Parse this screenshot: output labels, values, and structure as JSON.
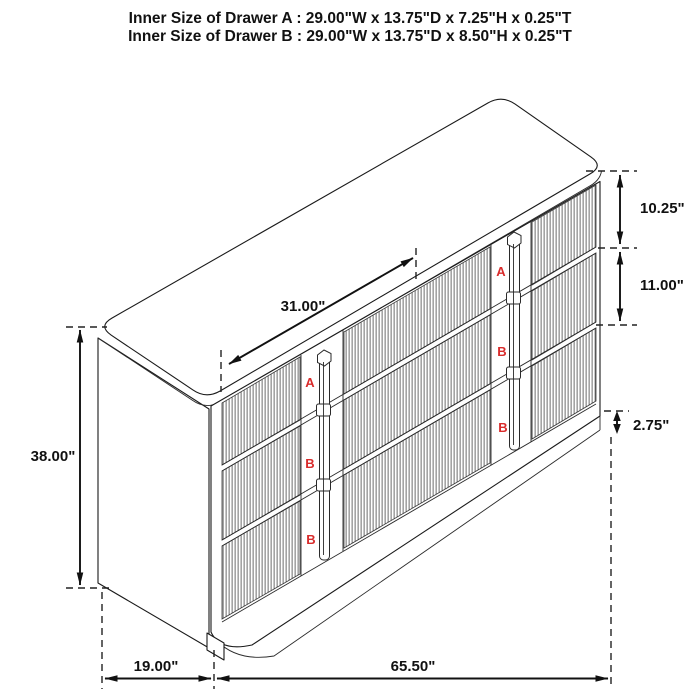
{
  "header": {
    "line_a": "Inner Size of Drawer A : 29.00\"W x 13.75\"D x 7.25\"H x 0.25\"T",
    "line_b": "Inner Size of Drawer B : 29.00\"W x 13.75\"D x 8.50\"H x 0.25\"T"
  },
  "dimensions": {
    "top_width": "31.00\"",
    "overall_height": "38.00\"",
    "drawer_a_height": "10.25\"",
    "drawer_b_height": "11.00\"",
    "base_height": "2.75\"",
    "side_depth": "19.00\"",
    "overall_width": "65.50\""
  },
  "drawer_labels": {
    "left": [
      "A",
      "B",
      "B"
    ],
    "right": [
      "A",
      "B",
      "B"
    ]
  },
  "colors": {
    "line": "#1a1a1a",
    "label_red": "#d92b2b",
    "background": "#ffffff"
  }
}
